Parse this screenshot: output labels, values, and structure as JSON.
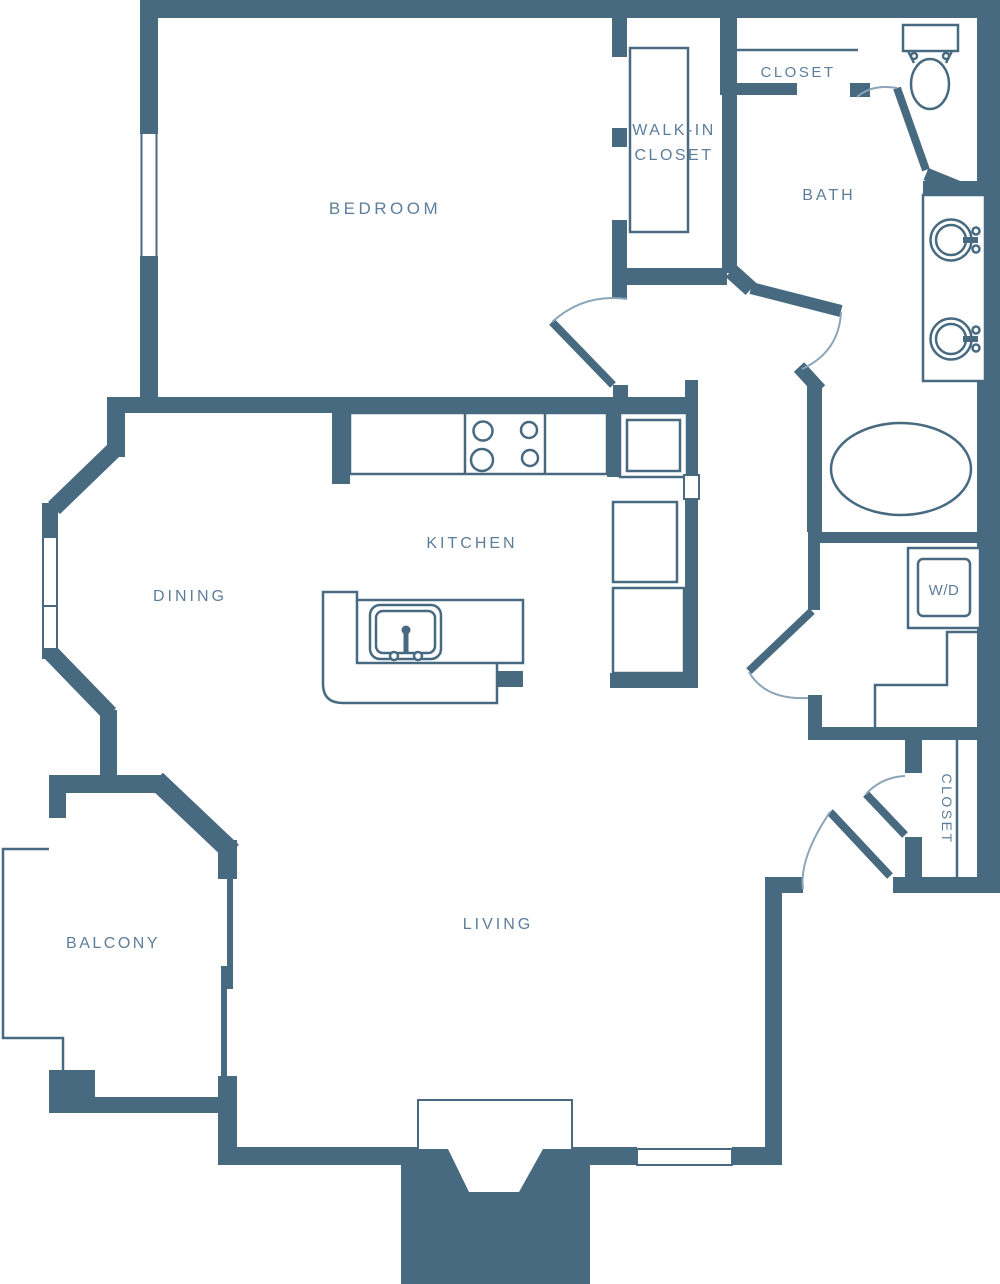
{
  "title": "Apartment Floor Plan",
  "colors": {
    "wall": "#486A81",
    "label": "#5D7E9B",
    "arc": "#8AA4B8",
    "bg": "#FFFFFF"
  },
  "rooms": {
    "bedroom": {
      "label": "BEDROOM"
    },
    "walk_in_closet": {
      "label_line1": "WALK-IN",
      "label_line2": "CLOSET"
    },
    "closet_top": {
      "label": "CLOSET"
    },
    "bath": {
      "label": "BATH"
    },
    "kitchen": {
      "label": "KITCHEN"
    },
    "dining": {
      "label": "DINING"
    },
    "living": {
      "label": "LIVING"
    },
    "balcony": {
      "label": "BALCONY"
    },
    "laundry": {
      "label": "W/D"
    },
    "closet_hall": {
      "label": "CLOSET"
    }
  },
  "fixtures": {
    "toilet": "toilet",
    "vanity_sinks": 2,
    "bathtub": "oval tub",
    "stove_burners": 4,
    "refrigerator": 1,
    "island_sink": 1,
    "washer_dryer": "stacked W/D"
  }
}
